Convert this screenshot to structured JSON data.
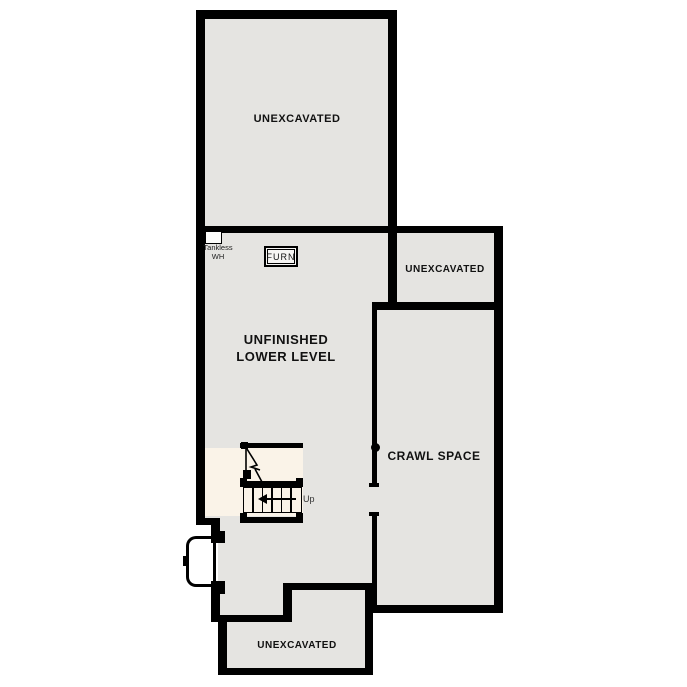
{
  "plan": {
    "type": "floor-plan",
    "rooms": {
      "unexcavated_top": {
        "label": "UNEXCAVATED"
      },
      "unexcavated_right": {
        "label": "UNEXCAVATED"
      },
      "unfinished_lower_level": {
        "label_line1": "UNFINISHED",
        "label_line2": "LOWER LEVEL"
      },
      "crawl_space": {
        "label": "CRAWL SPACE"
      },
      "unexcavated_bottom": {
        "label": "UNEXCAVATED"
      }
    },
    "equipment": {
      "tankless_water_heater": {
        "label_line1": "Tankless",
        "label_line2": "WH"
      },
      "furnace": {
        "label": "FURN"
      }
    },
    "stairs": {
      "direction_label": "Up"
    },
    "colors": {
      "wall": "#000000",
      "room_fill": "#e5e4e1",
      "stair_fill": "#faf3e8",
      "window_well_fill": "#ffffff",
      "background": "#ffffff"
    }
  }
}
